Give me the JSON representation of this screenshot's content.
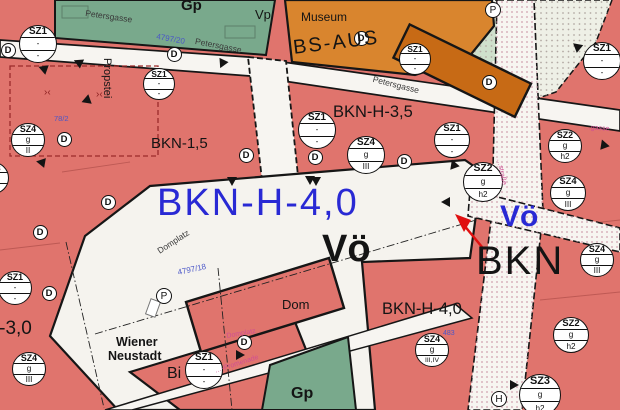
{
  "colors": {
    "k": "#141414",
    "g": "#3a3a3a",
    "b1": "#2929d4",
    "b2": "#4a56c8",
    "p": "#cf4f94",
    "dr": "#8b2020",
    "zone_red": "#e0746d",
    "zone_green": "#79a98c",
    "zone_orange": "#d9852e",
    "building_orange": "#c76a15",
    "street_white": "#f7f5f1",
    "arrow_red": "#e01010"
  },
  "map": {
    "title": "Flächenwidmungsplan Wiener Neustadt",
    "labels": [
      {
        "id": "gp-top",
        "t": "Gp",
        "x": 181,
        "y": -2,
        "s": 15,
        "c": "k",
        "w": 600
      },
      {
        "id": "vp",
        "t": "Vp",
        "x": 255,
        "y": 8,
        "s": 13,
        "c": "k",
        "w": 500
      },
      {
        "id": "museum",
        "t": "Museum",
        "x": 301,
        "y": 11,
        "s": 12,
        "c": "k",
        "w": 400
      },
      {
        "id": "bs-aus",
        "t": "BS-AUS",
        "x": 292,
        "y": 38,
        "s": 20,
        "c": "k",
        "r": -7,
        "ls": 2,
        "w": 500
      },
      {
        "id": "petersgasse-1",
        "t": "Petersgasse",
        "x": 86,
        "y": 9,
        "s": 8.5,
        "c": "g",
        "r": 8
      },
      {
        "id": "parcel-4797-20",
        "t": "4797/20",
        "x": 157,
        "y": 33,
        "s": 8,
        "c": "b2",
        "r": 10
      },
      {
        "id": "petersgasse-2",
        "t": "Petersgasse",
        "x": 196,
        "y": 37,
        "s": 8.5,
        "c": "g",
        "r": 11
      },
      {
        "id": "petersgasse-3",
        "t": "Petersgasse",
        "x": 374,
        "y": 75,
        "s": 8.5,
        "c": "g",
        "r": 14
      },
      {
        "id": "propstei",
        "t": "Propstei",
        "x": 112,
        "y": 58,
        "s": 11,
        "c": "k",
        "r": 90,
        "w": 500
      },
      {
        "id": "bkn-h-35",
        "t": "BKN-H-3,5",
        "x": 333,
        "y": 104,
        "s": 16.5,
        "c": "k",
        "w": 500
      },
      {
        "id": "bkn-15",
        "t": "BKN-1,5",
        "x": 151,
        "y": 136,
        "s": 15,
        "c": "k",
        "w": 500
      },
      {
        "id": "bkn-h-40-blue",
        "t": "BKN-H-4,0",
        "x": 157,
        "y": 184,
        "s": 38,
        "c": "b1",
        "ls": 2,
        "w": 500
      },
      {
        "id": "voe-black",
        "t": "Vö",
        "x": 322,
        "y": 230,
        "s": 38,
        "c": "k",
        "w": 600
      },
      {
        "id": "voe-blue",
        "t": "Vö",
        "x": 500,
        "y": 202,
        "s": 30,
        "c": "b1",
        "w": 600
      },
      {
        "id": "bkn-black",
        "t": "BKN",
        "x": 476,
        "y": 241,
        "s": 40,
        "c": "k",
        "ls": 2,
        "w": 500
      },
      {
        "id": "bkn-h-40-black",
        "t": "BKN-H-4,0",
        "x": 382,
        "y": 301,
        "s": 16.5,
        "c": "k",
        "w": 500
      },
      {
        "id": "bkn-h-30",
        "t": "BKN-H-3,0",
        "x": -60,
        "y": 319,
        "s": 19,
        "c": "k",
        "w": 500
      },
      {
        "id": "dom",
        "t": "Dom",
        "x": 282,
        "y": 298,
        "s": 13,
        "c": "k",
        "w": 500
      },
      {
        "id": "wiener",
        "t": "Wiener",
        "x": 116,
        "y": 336,
        "s": 12.5,
        "c": "k",
        "w": 700
      },
      {
        "id": "neustadt",
        "t": "Neustadt",
        "x": 108,
        "y": 350,
        "s": 12.5,
        "c": "k",
        "w": 700
      },
      {
        "id": "bi",
        "t": "Bi",
        "x": 167,
        "y": 366,
        "s": 16,
        "c": "k",
        "w": 500
      },
      {
        "id": "gp-bottom",
        "t": "Gp",
        "x": 291,
        "y": 386,
        "s": 16,
        "c": "k",
        "w": 600
      },
      {
        "id": "domplatz-diag",
        "t": "Domplatz",
        "x": 156,
        "y": 248,
        "s": 8.5,
        "c": "g",
        "r": -33
      },
      {
        "id": "domplatz-pink",
        "t": "Domplatz",
        "x": 226,
        "y": 333,
        "s": 7,
        "c": "p",
        "r": -10
      },
      {
        "id": "parcel-4797-18",
        "t": "4797/18",
        "x": 177,
        "y": 269,
        "s": 8,
        "c": "b2",
        "r": -12
      },
      {
        "id": "parcel-78-2",
        "t": "78/2",
        "x": 54,
        "y": 115,
        "s": 7.5,
        "c": "b2"
      },
      {
        "id": "promenade",
        "t": "…-Promenade",
        "x": 214,
        "y": 368,
        "s": 7,
        "c": "p",
        "r": -18
      },
      {
        "id": "gasse-ne",
        "t": "…gasse",
        "x": 584,
        "y": 124,
        "s": 7,
        "c": "p",
        "r": 4
      },
      {
        "id": "strasse-vert",
        "t": "…straße",
        "x": 502,
        "y": 158,
        "s": 7,
        "c": "p",
        "r": 78
      },
      {
        "id": "parcel-483",
        "t": "483",
        "x": 443,
        "y": 330,
        "s": 7,
        "c": "b2"
      },
      {
        "id": "mark-a",
        "t": "›‹",
        "x": 44,
        "y": 88,
        "s": 10,
        "c": "dr"
      },
      {
        "id": "mark-b",
        "t": "›‹",
        "x": 96,
        "y": 90,
        "s": 10,
        "c": "dr"
      }
    ],
    "zone_circles": [
      {
        "x": 38,
        "y": 44,
        "r": 19,
        "rows": [
          "SZ1",
          "-",
          "-"
        ]
      },
      {
        "x": 159,
        "y": 84,
        "r": 16,
        "rows": [
          "SZ1",
          "-",
          "-"
        ]
      },
      {
        "x": 28,
        "y": 140,
        "r": 17,
        "rows": [
          "SZ4",
          "g",
          "II"
        ]
      },
      {
        "x": -7,
        "y": 178,
        "r": 16,
        "rows": [
          "SZ3",
          "g",
          "II"
        ]
      },
      {
        "x": 15,
        "y": 288,
        "r": 17,
        "rows": [
          "SZ1",
          "-",
          "-"
        ]
      },
      {
        "x": 29,
        "y": 369,
        "r": 17,
        "rows": [
          "SZ4",
          "g",
          "III"
        ]
      },
      {
        "x": 204,
        "y": 370,
        "r": 19,
        "rows": [
          "SZ1",
          "-",
          "-"
        ]
      },
      {
        "x": 415,
        "y": 59,
        "r": 16,
        "rows": [
          "SZ1",
          "-",
          "-"
        ]
      },
      {
        "x": 317,
        "y": 130,
        "r": 19,
        "rows": [
          "SZ1",
          "-",
          "-"
        ]
      },
      {
        "x": 366,
        "y": 155,
        "r": 19,
        "rows": [
          "SZ4",
          "g",
          "III"
        ]
      },
      {
        "x": 452,
        "y": 140,
        "r": 18,
        "rows": [
          "SZ1",
          "-",
          "-"
        ]
      },
      {
        "x": 602,
        "y": 61,
        "r": 19,
        "rows": [
          "SZ1",
          "-",
          "-"
        ]
      },
      {
        "x": 565,
        "y": 146,
        "r": 17,
        "rows": [
          "SZ2",
          "g",
          "h2"
        ]
      },
      {
        "x": 568,
        "y": 193,
        "r": 18,
        "rows": [
          "SZ4",
          "g",
          "III"
        ]
      },
      {
        "x": 483,
        "y": 182,
        "r": 20,
        "rows": [
          "SZ2",
          "g",
          "h2"
        ]
      },
      {
        "x": 597,
        "y": 260,
        "r": 17,
        "rows": [
          "SZ4",
          "g",
          "III"
        ]
      },
      {
        "x": 571,
        "y": 335,
        "r": 18,
        "rows": [
          "SZ2",
          "g",
          "h2"
        ]
      },
      {
        "x": 540,
        "y": 395,
        "r": 21,
        "rows": [
          "SZ3",
          "g",
          "h2"
        ]
      },
      {
        "x": 432,
        "y": 350,
        "r": 17,
        "rows": [
          "SZ4",
          "g",
          "III,IV"
        ]
      }
    ],
    "point_circles": [
      {
        "x": 8,
        "y": 50,
        "t": "D"
      },
      {
        "x": 174,
        "y": 54,
        "t": "D"
      },
      {
        "x": 64,
        "y": 139,
        "t": "D"
      },
      {
        "x": 49,
        "y": 293,
        "t": "D"
      },
      {
        "x": 244,
        "y": 342,
        "t": "D"
      },
      {
        "x": 361,
        "y": 38,
        "t": "D"
      },
      {
        "x": 489,
        "y": 82,
        "t": "D"
      },
      {
        "x": 315,
        "y": 157,
        "t": "D"
      },
      {
        "x": 404,
        "y": 161,
        "t": "D"
      },
      {
        "x": 108,
        "y": 202,
        "t": "D"
      },
      {
        "x": 40,
        "y": 232,
        "t": "D"
      },
      {
        "x": 246,
        "y": 155,
        "t": "D"
      },
      {
        "x": 164,
        "y": 296,
        "t": "P"
      },
      {
        "x": 493,
        "y": 10,
        "t": "P"
      },
      {
        "x": 499,
        "y": 399,
        "t": "H"
      }
    ]
  }
}
